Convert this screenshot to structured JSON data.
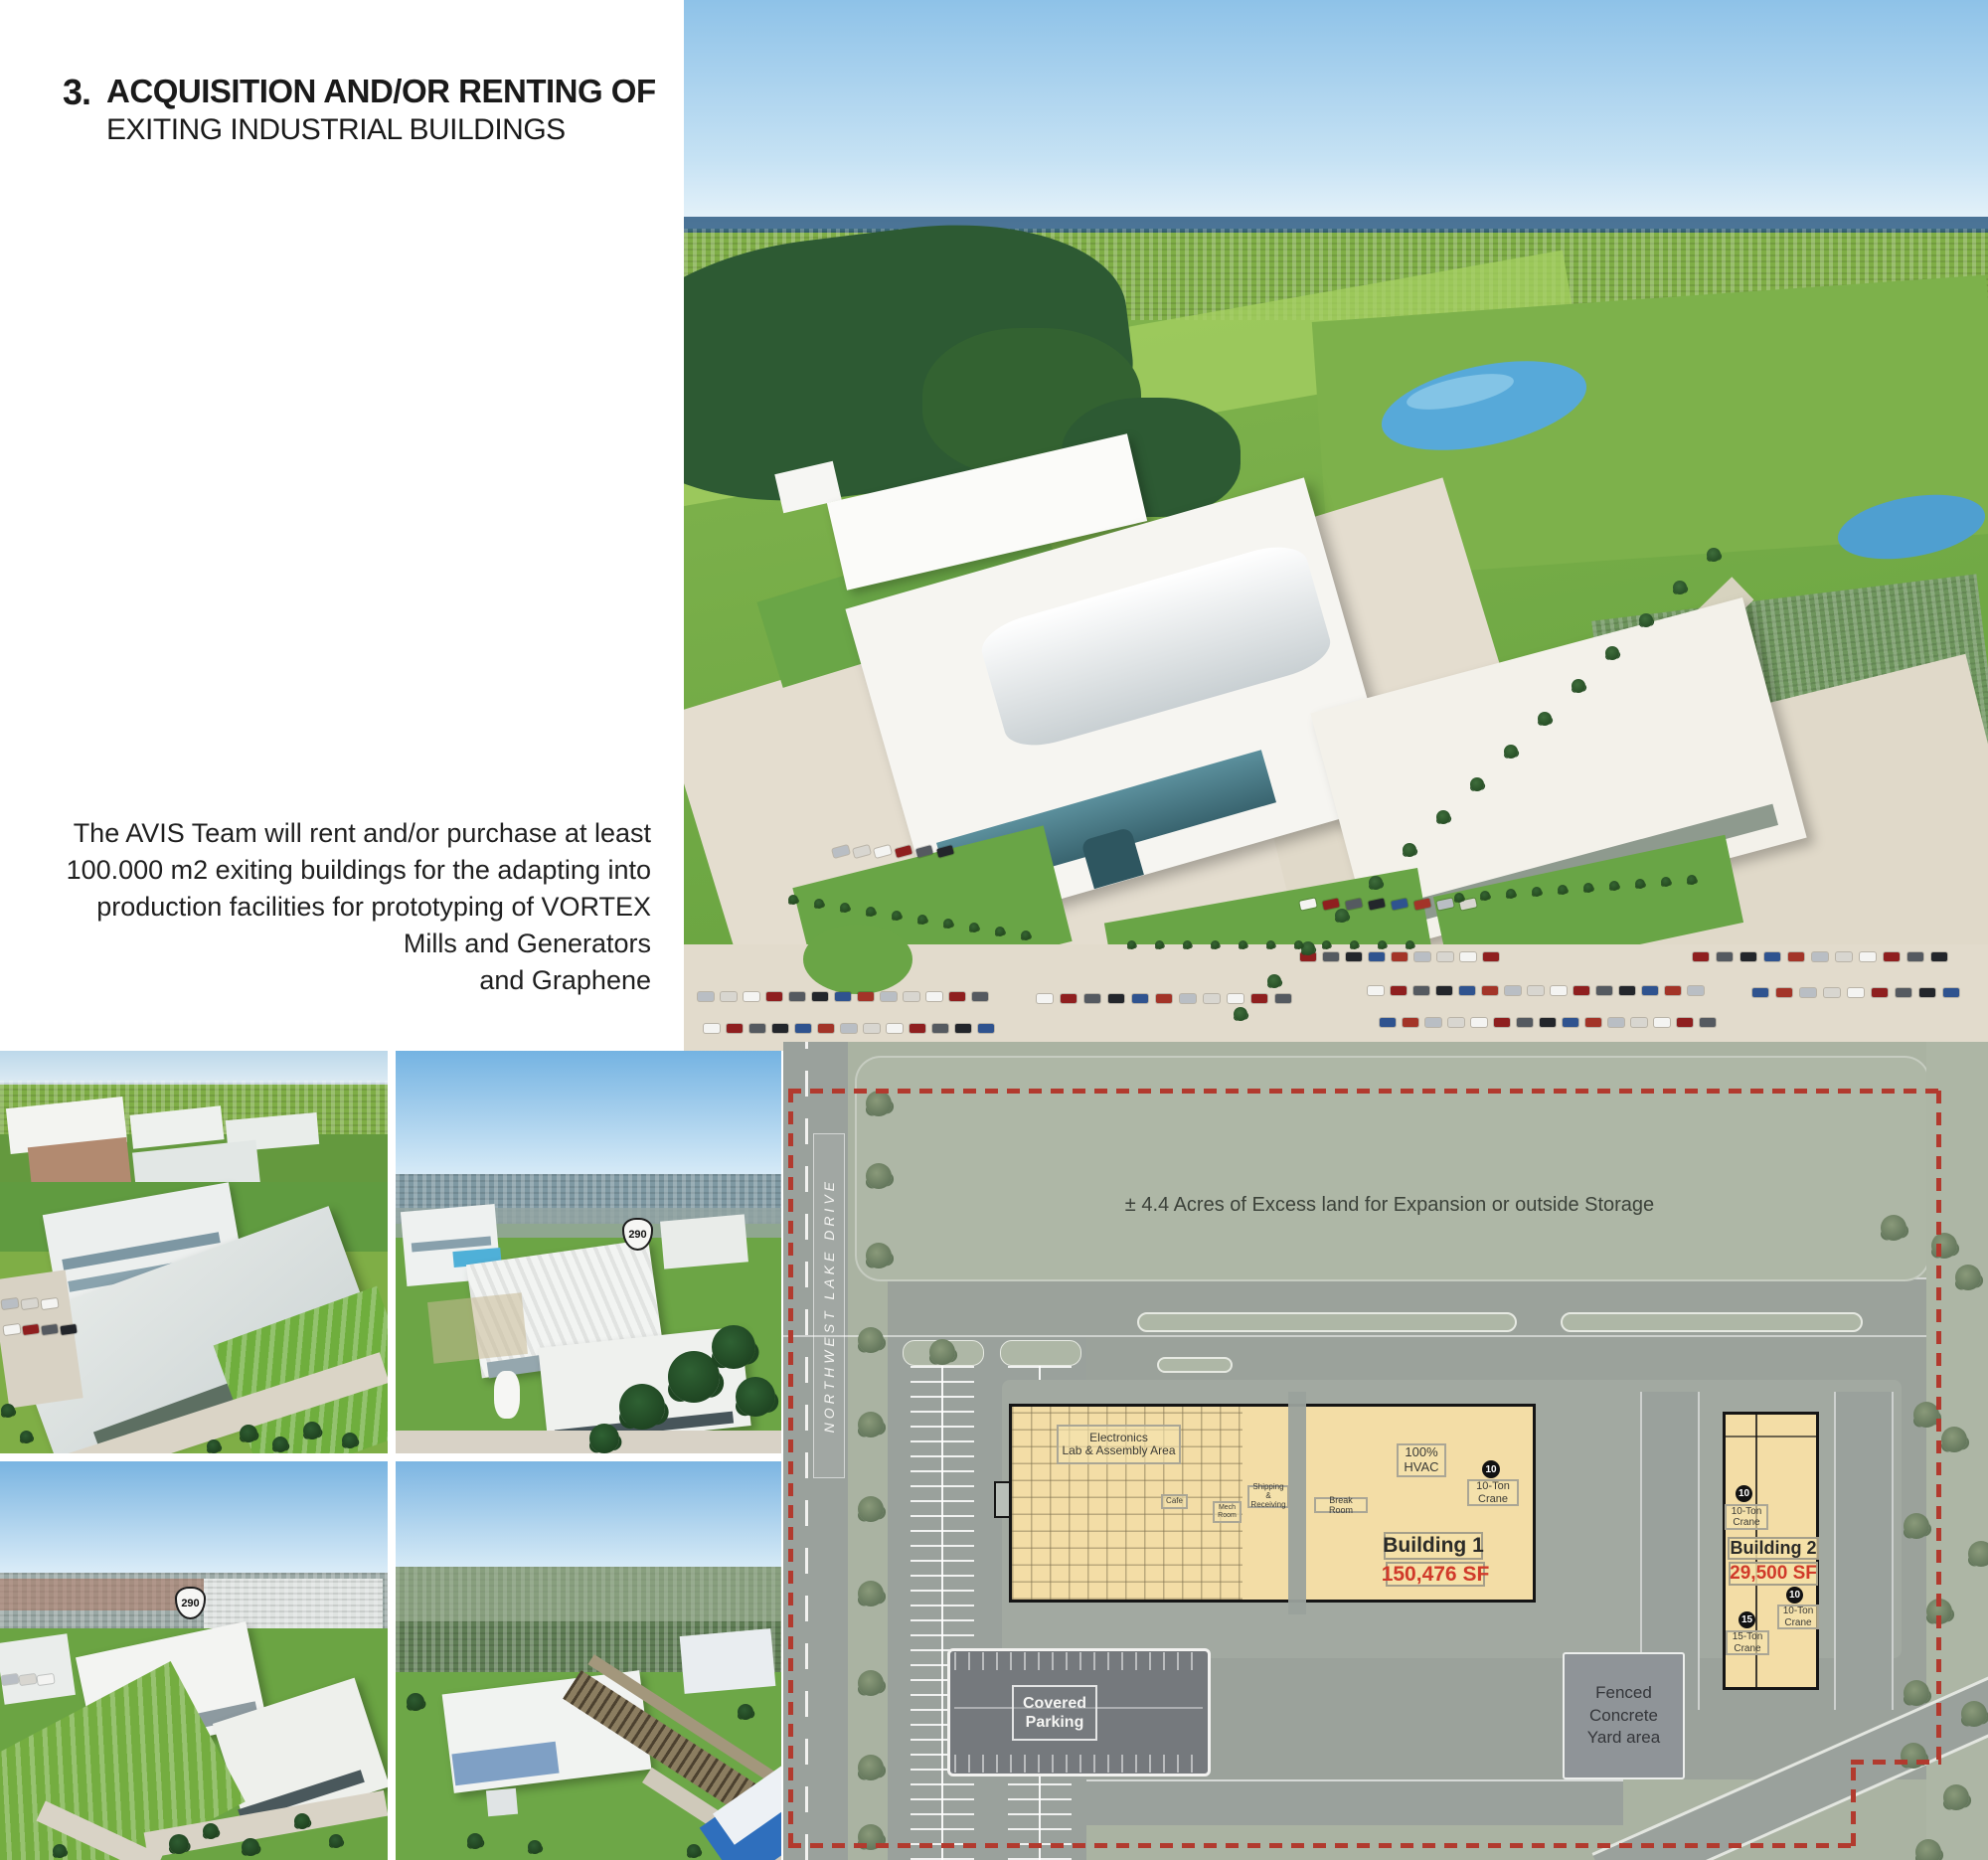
{
  "page": {
    "title_number": "3.",
    "title_line1": "ACQUISITION AND/OR RENTING OF",
    "title_line2": "EXITING INDUSTRIAL BUILDINGS",
    "paragraph_lines": [
      "The AVIS Team will rent and/or purchase at least",
      "100.000 m2 exiting buildings for the adapting into",
      "production facilities for prototyping of VORTEX",
      "Mills and Generators",
      "and Graphene"
    ]
  },
  "photos": {
    "shield_290": "290"
  },
  "siteplan": {
    "excess_land_note": "± 4.4 Acres of Excess land for Expansion or outside Storage",
    "street_name": "NORTHWEST LAKE DRIVE",
    "building1": {
      "name": "Building 1",
      "area": "150,476 SF",
      "rooms": {
        "electronics_line1": "Electronics",
        "electronics_line2": "Lab & Assembly Area",
        "cafe": "Cafe",
        "mech_line1": "Mech",
        "mech_line2": "Room",
        "shipping_line1": "Shipping &",
        "shipping_line2": "Receiving",
        "break_room": "Break Room",
        "hvac_line1": "100%",
        "hvac_line2": "HVAC"
      },
      "crane_badge": "10",
      "crane_line1": "10-Ton",
      "crane_line2": "Crane"
    },
    "building2": {
      "name": "Building 2",
      "area": "29,500 SF",
      "cranes": [
        {
          "badge": "10",
          "line1": "10-Ton",
          "line2": "Crane"
        },
        {
          "badge": "10",
          "line1": "10-Ton",
          "line2": "Crane"
        },
        {
          "badge": "15",
          "line1": "15-Ton",
          "line2": "Crane"
        }
      ]
    },
    "covered_parking_line1": "Covered",
    "covered_parking_line2": "Parking",
    "yard_line1": "Fenced",
    "yard_line2": "Concrete",
    "yard_line3": "Yard area"
  },
  "colors": {
    "sf_red": "#d03a2a",
    "boundary_red": "#b23a2e",
    "building_tan": "#f3dda6",
    "sage_green": "#aab3a2",
    "road_gray": "#9ba29b",
    "covered_parking_gray": "#75797d"
  }
}
